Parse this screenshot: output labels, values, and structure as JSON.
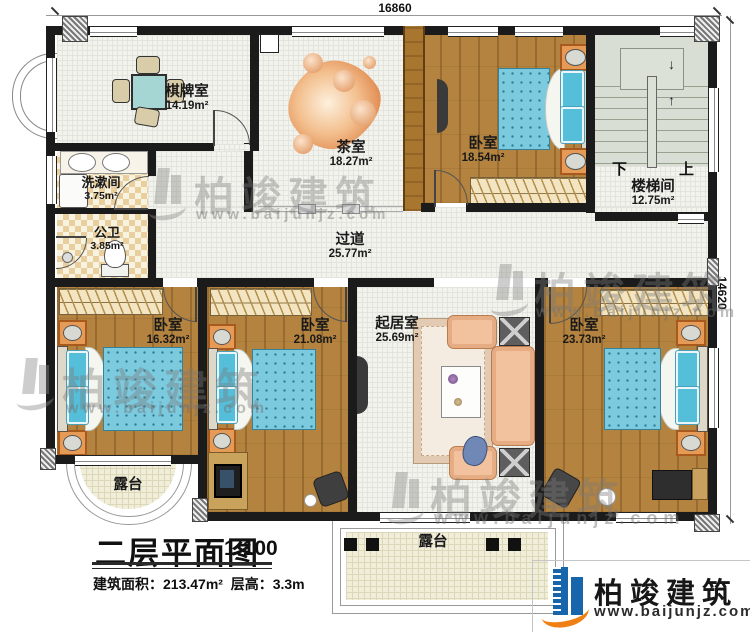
{
  "title": {
    "name": "二层平面图",
    "scale": "1:100",
    "area_label": "建筑面积：",
    "area_value": "213.47m²",
    "height_label": "层高：",
    "height_value": "3.3m"
  },
  "dimensions": {
    "width": "16860",
    "height": "14620"
  },
  "rooms": {
    "chess": {
      "name": "棋牌室",
      "area": "14.19m²"
    },
    "tea": {
      "name": "茶室",
      "area": "18.27m²"
    },
    "bedroom_top": {
      "name": "卧室",
      "area": "18.54m²"
    },
    "stair": {
      "name": "楼梯间",
      "area": "12.75m²"
    },
    "wash": {
      "name": "洗漱间",
      "area": "3.75m²"
    },
    "toilet": {
      "name": "公卫",
      "area": "3.85m²"
    },
    "corridor": {
      "name": "过道",
      "area": "25.77m²"
    },
    "bedroom_left": {
      "name": "卧室",
      "area": "16.32m²"
    },
    "bedroom_mid": {
      "name": "卧室",
      "area": "21.08m²"
    },
    "living": {
      "name": "起居室",
      "area": "25.69m²"
    },
    "bedroom_right": {
      "name": "卧室",
      "area": "23.73m²"
    },
    "terrace_left": {
      "name": "露台"
    },
    "terrace_bottom": {
      "name": "露台"
    }
  },
  "stair_marks": {
    "down": "下",
    "up": "上"
  },
  "watermark": {
    "brand": "柏竣建筑",
    "url": "www.baijunjz.com"
  },
  "logo": {
    "brand": "柏竣建筑",
    "url": "www.baijunjz.com"
  },
  "colors": {
    "wall": "#1b1b1b",
    "wood_floor": "#b3833f",
    "mattress_blue": "#7ccade",
    "sofa_peach": "#f2c29e",
    "checker_tan": "#e9cf9d",
    "logo_blue": "#1766ab",
    "logo_orange": "#f08013"
  }
}
